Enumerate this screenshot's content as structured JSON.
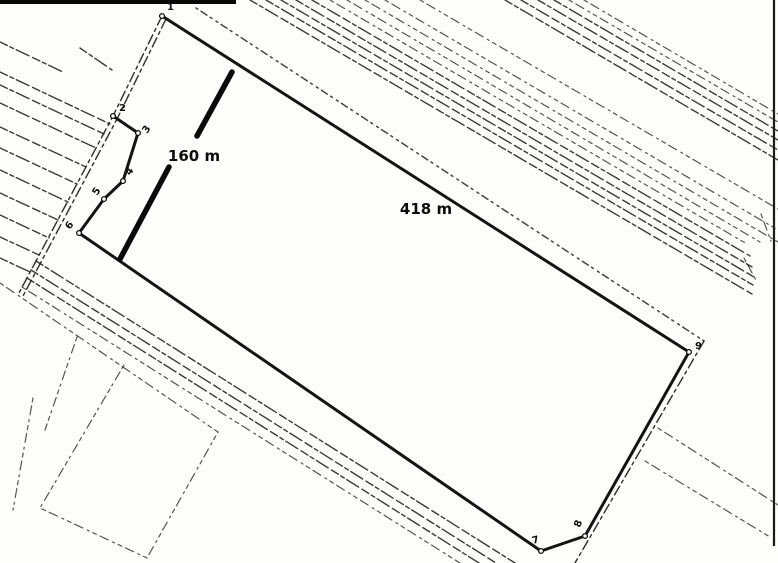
{
  "document": {
    "kind": "land-survey-sketch",
    "background_color": "#fdfdfc",
    "ink_color": "#141414"
  },
  "dimensions": [
    {
      "text": "160 m",
      "x": 194,
      "y": 161
    },
    {
      "text": "418 m",
      "x": 426,
      "y": 214
    }
  ],
  "vertices": [
    {
      "n": "1",
      "x": 162,
      "y": 16,
      "lx": 167,
      "ly": 10,
      "rot": 0
    },
    {
      "n": "2",
      "x": 113,
      "y": 116,
      "lx": 119,
      "ly": 111,
      "rot": 0
    },
    {
      "n": "3",
      "x": 138,
      "y": 133,
      "lx": 147,
      "ly": 134,
      "rot": -55
    },
    {
      "n": "4",
      "x": 123,
      "y": 181,
      "lx": 130,
      "ly": 176,
      "rot": -55
    },
    {
      "n": "5",
      "x": 104,
      "y": 199,
      "lx": 97,
      "ly": 196,
      "rot": -55
    },
    {
      "n": "6",
      "x": 79,
      "y": 233,
      "lx": 70,
      "ly": 230,
      "rot": -55
    },
    {
      "n": "7",
      "x": 541,
      "y": 551,
      "lx": 533,
      "ly": 544,
      "rot": -15
    },
    {
      "n": "8",
      "x": 585,
      "y": 536,
      "lx": 580,
      "ly": 528,
      "rot": -70
    },
    {
      "n": "9",
      "x": 689,
      "y": 352,
      "lx": 695,
      "ly": 349,
      "rot": 0
    }
  ],
  "drawing": {
    "lines": [
      {
        "name": "parcel-boundary",
        "style": "parcel",
        "pts": [
          [
            113,
            116
          ],
          [
            138,
            133
          ],
          [
            123,
            181
          ],
          [
            104,
            199
          ],
          [
            79,
            233
          ],
          [
            541,
            551
          ],
          [
            585,
            536
          ],
          [
            689,
            352
          ],
          [
            162,
            16
          ]
        ]
      },
      {
        "name": "dimension-bar-160m-upper",
        "style": "bar",
        "pts": [
          [
            232,
            72
          ],
          [
            197,
            136
          ]
        ]
      },
      {
        "name": "dimension-bar-160m-lower",
        "style": "bar",
        "pts": [
          [
            169,
            167
          ],
          [
            120,
            259
          ]
        ]
      },
      {
        "name": "scan-border-top",
        "style": "borderbar",
        "pts": [
          [
            0,
            2
          ],
          [
            236,
            2
          ]
        ]
      },
      {
        "name": "scan-border-right",
        "style": "borderthin",
        "pts": [
          [
            774,
            0
          ],
          [
            774,
            546
          ]
        ]
      },
      {
        "name": "road-left-edge-a",
        "style": "roaddash",
        "pts": [
          [
            162,
            16
          ],
          [
            113,
            116
          ],
          [
            19,
            293
          ]
        ]
      },
      {
        "name": "road-left-edge-b",
        "style": "roaddash",
        "pts": [
          [
            166,
            19
          ],
          [
            117,
            119
          ],
          [
            23,
            296
          ]
        ]
      },
      {
        "name": "road-parallel-top",
        "style": "dotline",
        "pts": [
          [
            196,
            8
          ],
          [
            704,
            341
          ]
        ]
      },
      {
        "name": "road-parallel-right",
        "style": "roaddash",
        "pts": [
          [
            704,
            341
          ],
          [
            575,
            563
          ]
        ]
      },
      {
        "name": "road-branch-1",
        "style": "sketchlight",
        "pts": [
          [
            658,
            428
          ],
          [
            778,
            505
          ]
        ]
      },
      {
        "name": "road-branch-2",
        "style": "sketchlight",
        "pts": [
          [
            645,
            461
          ],
          [
            770,
            537
          ]
        ]
      },
      {
        "name": "field-line",
        "style": "sketch",
        "pts": [
          [
            0,
            42
          ],
          [
            63,
            72
          ]
        ]
      },
      {
        "name": "field-line",
        "style": "sketch",
        "pts": [
          [
            80,
            48
          ],
          [
            112,
            70
          ]
        ]
      },
      {
        "name": "field-line",
        "style": "sketch",
        "pts": [
          [
            0,
            72
          ],
          [
            110,
            124
          ]
        ]
      },
      {
        "name": "field-line",
        "style": "sketch",
        "pts": [
          [
            0,
            85
          ],
          [
            104,
            134
          ]
        ]
      },
      {
        "name": "field-line",
        "style": "sketch",
        "pts": [
          [
            0,
            103
          ],
          [
            96,
            148
          ]
        ]
      },
      {
        "name": "field-line",
        "style": "sketch",
        "pts": [
          [
            0,
            127
          ],
          [
            86,
            167
          ]
        ]
      },
      {
        "name": "field-line",
        "style": "sketch",
        "pts": [
          [
            0,
            148
          ],
          [
            77,
            184
          ]
        ]
      },
      {
        "name": "field-line",
        "style": "sketch",
        "pts": [
          [
            0,
            170
          ],
          [
            68,
            202
          ]
        ]
      },
      {
        "name": "field-line",
        "style": "sketch",
        "pts": [
          [
            0,
            193
          ],
          [
            58,
            220
          ]
        ]
      },
      {
        "name": "field-line",
        "style": "sketch",
        "pts": [
          [
            0,
            215
          ],
          [
            49,
            238
          ]
        ]
      },
      {
        "name": "field-line",
        "style": "sketch",
        "pts": [
          [
            0,
            237
          ],
          [
            39,
            255
          ]
        ]
      },
      {
        "name": "field-line",
        "style": "sketch",
        "pts": [
          [
            0,
            258
          ],
          [
            30,
            272
          ]
        ]
      },
      {
        "name": "road-upper-line",
        "style": "sketch",
        "pts": [
          [
            250,
            0
          ],
          [
            752,
            294
          ]
        ]
      },
      {
        "name": "road-upper-line",
        "style": "sketch",
        "pts": [
          [
            266,
            0
          ],
          [
            753,
            285
          ]
        ]
      },
      {
        "name": "road-upper-line",
        "style": "sketch",
        "pts": [
          [
            281,
            0
          ],
          [
            754,
            277
          ]
        ]
      },
      {
        "name": "road-upper-line",
        "style": "sketch",
        "pts": [
          [
            296,
            0
          ],
          [
            752,
            267
          ]
        ]
      },
      {
        "name": "road-upper-line",
        "style": "sketch",
        "pts": [
          [
            312,
            0
          ],
          [
            750,
            256
          ]
        ]
      },
      {
        "name": "road-upper-line",
        "style": "sketchlight",
        "pts": [
          [
            330,
            0
          ],
          [
            747,
            244
          ]
        ]
      },
      {
        "name": "road-upper-line",
        "style": "sketchlight",
        "pts": [
          [
            347,
            0
          ],
          [
            760,
            242
          ]
        ]
      },
      {
        "name": "road-upper-line",
        "style": "sketchlight",
        "pts": [
          [
            365,
            0
          ],
          [
            778,
            242
          ]
        ]
      },
      {
        "name": "road-upper-line",
        "style": "sketchlight",
        "pts": [
          [
            385,
            0
          ],
          [
            778,
            230
          ]
        ]
      },
      {
        "name": "road-upper-line",
        "style": "sketchlight",
        "pts": [
          [
            420,
            0
          ],
          [
            778,
            209
          ]
        ]
      },
      {
        "name": "road-upper-end-tick",
        "style": "sketchlight",
        "pts": [
          [
            744,
            258
          ],
          [
            757,
            282
          ]
        ]
      },
      {
        "name": "road-upper-end-tick",
        "style": "sketchlight",
        "pts": [
          [
            761,
            214
          ],
          [
            771,
            241
          ]
        ]
      },
      {
        "name": "road-corner-line",
        "style": "sketch",
        "pts": [
          [
            505,
            0
          ],
          [
            778,
            160
          ]
        ]
      },
      {
        "name": "road-corner-line",
        "style": "sketch",
        "pts": [
          [
            521,
            0
          ],
          [
            778,
            150
          ]
        ]
      },
      {
        "name": "road-corner-line",
        "style": "sketch",
        "pts": [
          [
            538,
            0
          ],
          [
            778,
            140
          ]
        ]
      },
      {
        "name": "road-corner-line",
        "style": "sketch",
        "pts": [
          [
            554,
            0
          ],
          [
            778,
            131
          ]
        ]
      },
      {
        "name": "road-corner-line",
        "style": "sketchlight",
        "pts": [
          [
            569,
            0
          ],
          [
            778,
            122
          ]
        ]
      },
      {
        "name": "road-corner-line",
        "style": "sketchlight",
        "pts": [
          [
            584,
            0
          ],
          [
            778,
            114
          ]
        ]
      },
      {
        "name": "road-lower-line",
        "style": "sketch",
        "pts": [
          [
            36,
            261
          ],
          [
            515,
            563
          ]
        ]
      },
      {
        "name": "road-lower-line",
        "style": "sketch",
        "pts": [
          [
            31,
            270
          ],
          [
            496,
            563
          ]
        ]
      },
      {
        "name": "road-lower-line",
        "style": "sketch",
        "pts": [
          [
            27,
            278
          ],
          [
            479,
            563
          ]
        ]
      },
      {
        "name": "road-lower-line",
        "style": "sketchlight",
        "pts": [
          [
            22,
            287
          ],
          [
            460,
            563
          ]
        ]
      },
      {
        "name": "field-boundary-long",
        "style": "sketchlight",
        "pts": [
          [
            0,
            283
          ],
          [
            218,
            432
          ]
        ]
      },
      {
        "name": "field-parcel-outline",
        "style": "sketchlight",
        "pts": [
          [
            124,
            365
          ],
          [
            40,
            508
          ],
          [
            147,
            558
          ],
          [
            218,
            432
          ]
        ]
      },
      {
        "name": "field-boundary-short",
        "style": "sketchlight",
        "pts": [
          [
            77,
            337
          ],
          [
            45,
            430
          ]
        ]
      },
      {
        "name": "field-boundary-short",
        "style": "sketchlight",
        "pts": [
          [
            33,
            398
          ],
          [
            13,
            510
          ]
        ]
      }
    ]
  }
}
